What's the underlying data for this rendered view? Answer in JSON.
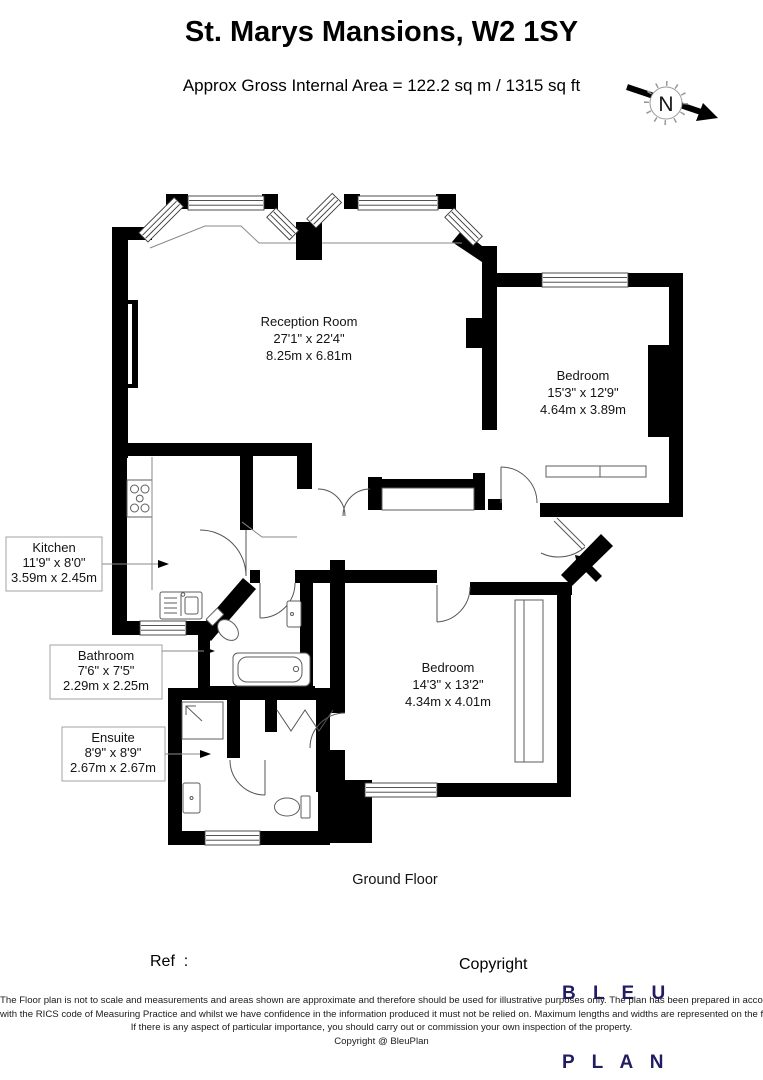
{
  "header": {
    "title": "St. Marys Mansions, W2 1SY",
    "subtitle": "Approx Gross Internal Area = 122.2 sq m / 1315 sq ft",
    "compass_n": "N"
  },
  "rooms": {
    "reception": {
      "name": "Reception Room",
      "imperial": "27'1\" x 22'4\"",
      "metric": "8.25m x 6.81m"
    },
    "bedroom1": {
      "name": "Bedroom",
      "imperial": "15'3\" x 12'9\"",
      "metric": "4.64m x 3.89m"
    },
    "bedroom2": {
      "name": "Bedroom",
      "imperial": "14'3\" x 13'2\"",
      "metric": "4.34m x 4.01m"
    },
    "kitchen": {
      "name": "Kitchen",
      "imperial": "11'9\" x 8'0\"",
      "metric": "3.59m x 2.45m"
    },
    "bathroom": {
      "name": "Bathroom",
      "imperial": "7'6\" x 7'5\"",
      "metric": "2.29m x 2.25m"
    },
    "ensuite": {
      "name": "Ensuite",
      "imperial": "8'9\" x 8'9\"",
      "metric": "2.67m x 2.67m"
    }
  },
  "floor_label": "Ground Floor",
  "footer": {
    "ref_label": "Ref  :",
    "copyright_label": "Copyright",
    "logo_line1": "B L E U",
    "logo_line2": "P L A N"
  },
  "disclaimer": {
    "line1": "The Floor plan is not to scale and measurements and areas shown are approximate and therefore should be used for illustrative purposes only. The plan has been prepared in accordance",
    "line2": "with the RICS code of Measuring Practice and whilst we have confidence in the information produced it must not be relied on. Maximum lengths and widths are represented on the floor plan.",
    "line3": "If there is any aspect of particular importance, you should carry out or commission your own inspection of the property.",
    "line4": "Copyright @ BleuPlan"
  },
  "colors": {
    "wall": "#000000",
    "logo": "#221c63",
    "label_border": "#a3a3a3"
  }
}
